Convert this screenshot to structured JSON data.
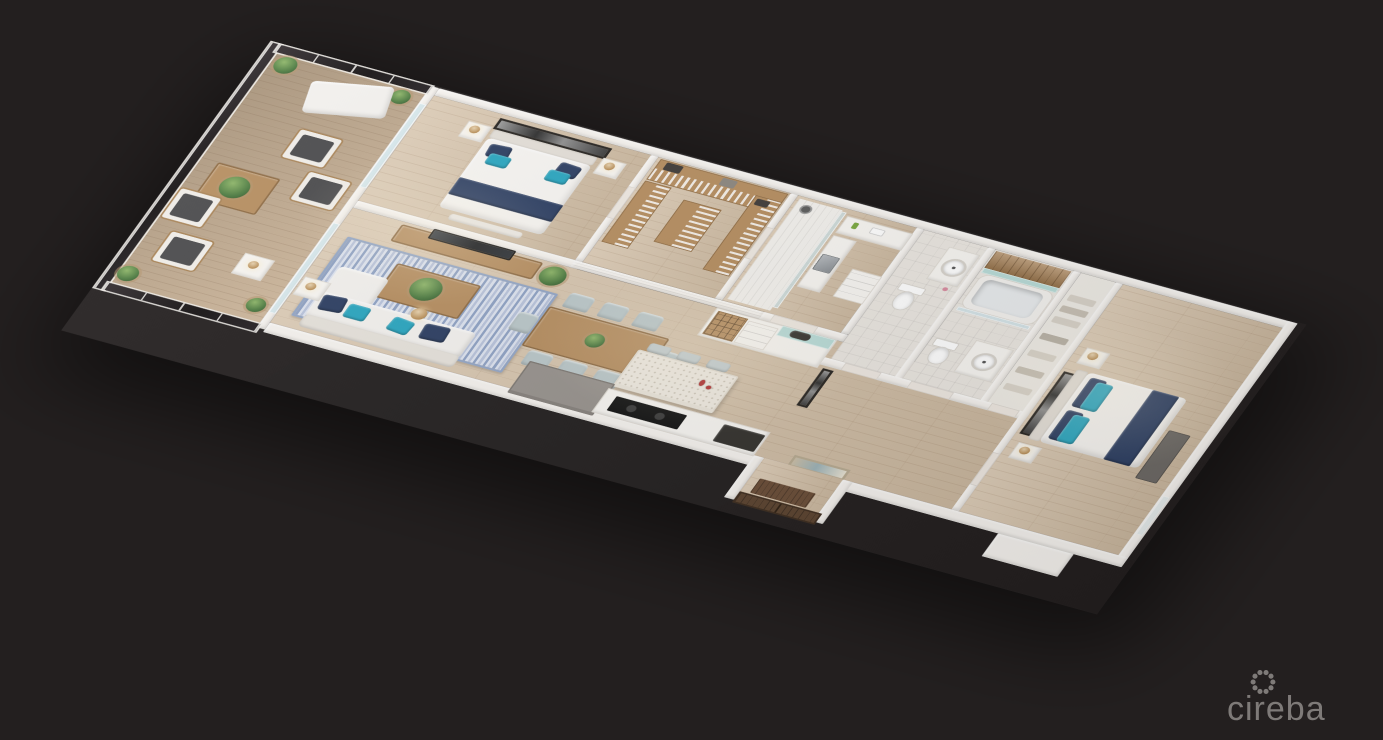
{
  "scene": {
    "type": "3d-floor-plan-render",
    "description": "Isometric 3D rendering of a two-bedroom apartment floor plan on a dark background",
    "rooms": [
      "balcony",
      "master-bedroom",
      "walk-in-closet",
      "master-bathroom",
      "powder-room",
      "second-bathroom",
      "linen-closet",
      "second-bedroom",
      "living-room",
      "dining-area",
      "kitchen",
      "entry-hall",
      "entry-vestibule"
    ],
    "furniture_icons": [
      "lounge-chair",
      "outdoor-armchair",
      "coffee-table",
      "potted-plant",
      "double-bed",
      "nightstand",
      "table-lamp",
      "artwork",
      "tv",
      "tv-console",
      "area-rug",
      "sofa",
      "chaise",
      "floor-lamp",
      "side-table",
      "dining-table",
      "dining-chair",
      "kitchen-island",
      "bar-stool",
      "wine-rack",
      "kitchen-sink",
      "cooktop",
      "wardrobe-shelving",
      "walk-in-shower",
      "glass-screen",
      "toilet",
      "vanity-sink",
      "bathtub",
      "wood-accent-wall",
      "linen-shelves",
      "dresser",
      "entry-door",
      "door-mat"
    ]
  },
  "watermark": {
    "brand": "cireba",
    "logo_icon": "dotted-circle-logo"
  },
  "colors": {
    "background": "#231F1F",
    "wall": "#F6F3EF",
    "floor_wood": "#D6C2A8",
    "deck_wood": "#C9B092",
    "tile_light": "#EBE7E1",
    "glass_dark": "#1A1517",
    "glass_light": "#CFE4EB",
    "accent_teal": "#2AA6C0",
    "accent_navy": "#2C3E62",
    "rug_blue": "#8FA2C4",
    "wood_furniture": "#B68E60",
    "wood_dark": "#8F6C44",
    "aqua_tile": "#B9DCD8",
    "gray_counter": "#98938E",
    "dark_counter": "#35332F",
    "entry_door_wood": "#5C4430",
    "plant_green": "#4C7A40",
    "upholstery_light": "#F3F1EE",
    "cushion_dark": "#4A4A4C",
    "marble": "#EFEAE1",
    "watermark_gray": "#8F8B89"
  }
}
